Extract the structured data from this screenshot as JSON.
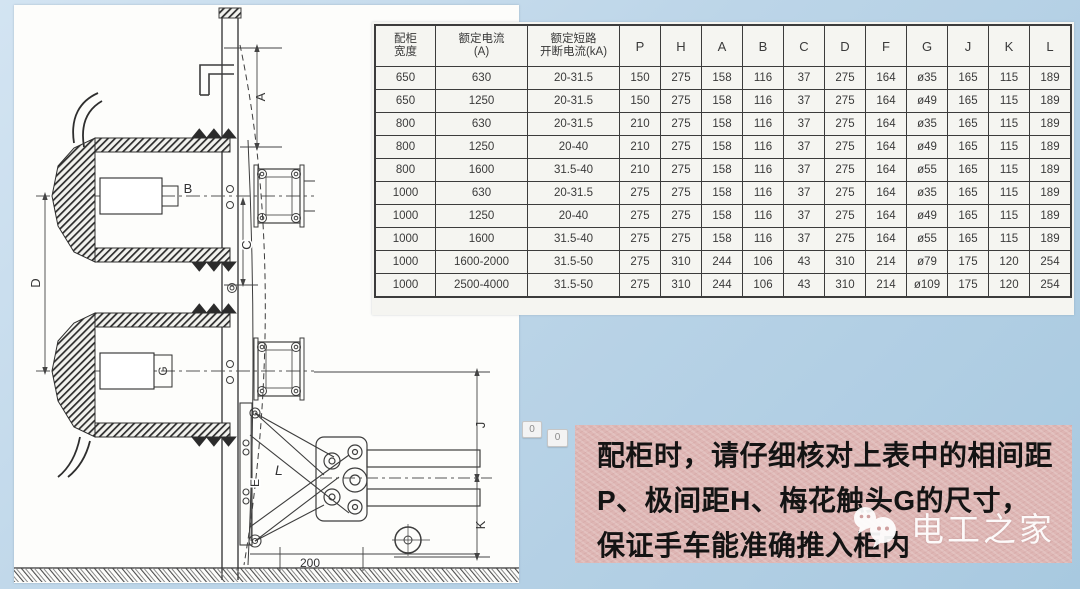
{
  "page": {
    "background_top_color": "#d3e4f2",
    "background_bottom_color": "#a8c9e0",
    "note_box_color": "#deb6b4",
    "paper_color": "#f5f5f1"
  },
  "table": {
    "headers": [
      [
        "配柜",
        "宽度"
      ],
      [
        "额定电流",
        "(A)"
      ],
      [
        "额定短路",
        "开断电流(kA)"
      ],
      "P",
      "H",
      "A",
      "B",
      "C",
      "D",
      "F",
      "G",
      "J",
      "K",
      "L"
    ],
    "rows": [
      [
        "650",
        "630",
        "20-31.5",
        "150",
        "275",
        "158",
        "116",
        "37",
        "275",
        "164",
        "ø35",
        "165",
        "115",
        "189"
      ],
      [
        "650",
        "1250",
        "20-31.5",
        "150",
        "275",
        "158",
        "116",
        "37",
        "275",
        "164",
        "ø49",
        "165",
        "115",
        "189"
      ],
      [
        "800",
        "630",
        "20-31.5",
        "210",
        "275",
        "158",
        "116",
        "37",
        "275",
        "164",
        "ø35",
        "165",
        "115",
        "189"
      ],
      [
        "800",
        "1250",
        "20-40",
        "210",
        "275",
        "158",
        "116",
        "37",
        "275",
        "164",
        "ø49",
        "165",
        "115",
        "189"
      ],
      [
        "800",
        "1600",
        "31.5-40",
        "210",
        "275",
        "158",
        "116",
        "37",
        "275",
        "164",
        "ø55",
        "165",
        "115",
        "189"
      ],
      [
        "1000",
        "630",
        "20-31.5",
        "275",
        "275",
        "158",
        "116",
        "37",
        "275",
        "164",
        "ø35",
        "165",
        "115",
        "189"
      ],
      [
        "1000",
        "1250",
        "20-40",
        "275",
        "275",
        "158",
        "116",
        "37",
        "275",
        "164",
        "ø49",
        "165",
        "115",
        "189"
      ],
      [
        "1000",
        "1600",
        "31.5-40",
        "275",
        "275",
        "158",
        "116",
        "37",
        "275",
        "164",
        "ø55",
        "165",
        "115",
        "189"
      ],
      [
        "1000",
        "1600-2000",
        "31.5-50",
        "275",
        "310",
        "244",
        "106",
        "43",
        "310",
        "214",
        "ø79",
        "175",
        "120",
        "254"
      ],
      [
        "1000",
        "2500-4000",
        "31.5-50",
        "275",
        "310",
        "244",
        "106",
        "43",
        "310",
        "214",
        "ø109",
        "175",
        "120",
        "254"
      ]
    ]
  },
  "badges": [
    "0",
    "0"
  ],
  "note": {
    "lines": [
      "配柜时，请仔细核对上表中的相间距",
      "P、极间距H、梅花触头G的尺寸，",
      "保证手车能准确推入柜内"
    ]
  },
  "watermark": {
    "label": "电工之家"
  },
  "diagram": {
    "labels": {
      "A": "A",
      "B": "B",
      "C": "C",
      "D": "D",
      "E": "E",
      "G": "G",
      "J": "J",
      "K": "K",
      "L": "L",
      "dim200": "200"
    }
  }
}
